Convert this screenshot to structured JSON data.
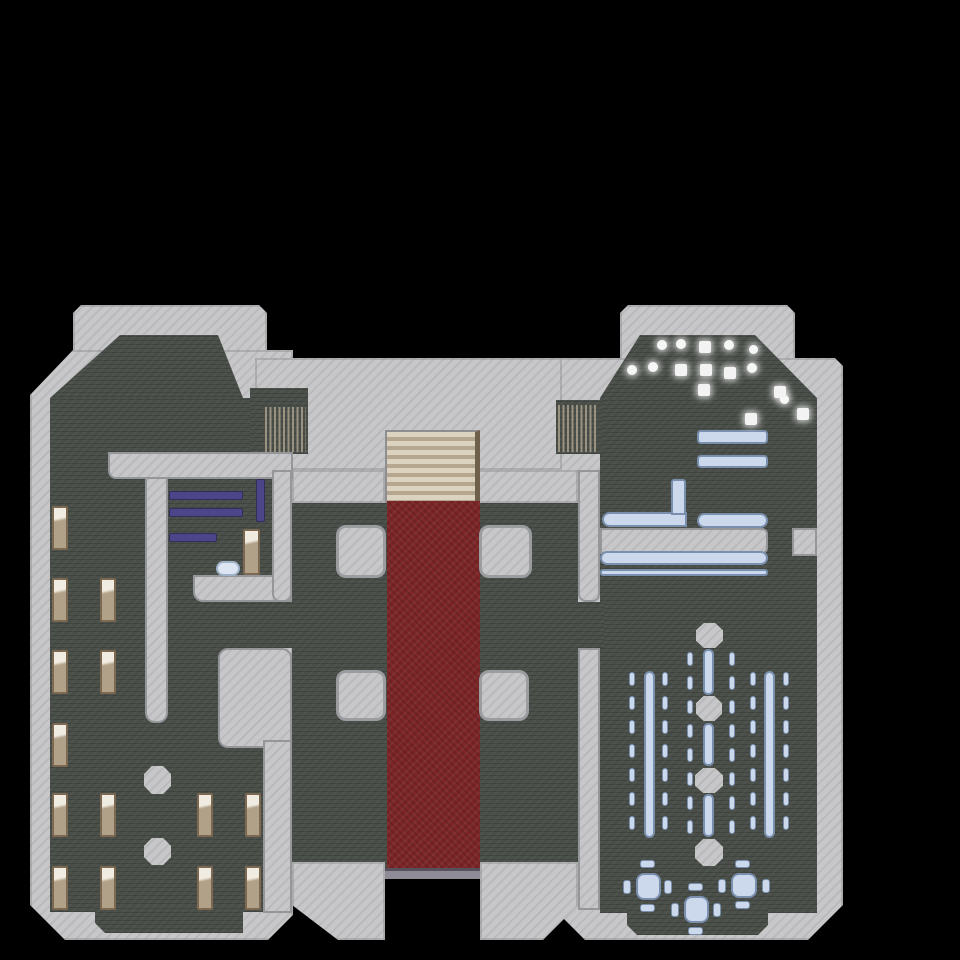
{
  "scene": {
    "name": "castle-floor-map",
    "background": "#000000",
    "width": 960,
    "height": 960
  },
  "palette": {
    "wall": "#c7c7c9",
    "wall_hatch": "#b8b8ba",
    "wall_trim": "#94969a",
    "floor": "#494e48",
    "carpet": "#7d2628",
    "stairs": "#dbd2c0",
    "stairs_stripe": "#b5a78f",
    "wood": "#b2a189",
    "wood_border": "#7d6951",
    "purple": "#4d4589",
    "blue_furniture": "#ccd9ec",
    "blue_border": "#7a8fae",
    "item_white": "#f6f6f6",
    "threshold": "#908c97"
  },
  "elements": [
    {
      "n": "tower-left-wall-cap",
      "c": "wall",
      "x": 73,
      "y": 305,
      "w": 194,
      "h": 90,
      "s": {
        "clipPath": "polygon(8px 0,186px 0,194px 8px,194px 90px,0 90px,0 8px)"
      }
    },
    {
      "n": "wing-left-wall",
      "c": "wall",
      "x": 30,
      "y": 350,
      "w": 263,
      "h": 590,
      "s": {
        "clipPath": "polygon(43px 0,263px 0,263px 565px,238px 590px,35px 590px,0 555px,0 45px)"
      }
    },
    {
      "n": "hall-top-wall-band",
      "c": "wall",
      "x": 255,
      "y": 358,
      "w": 355,
      "h": 112
    },
    {
      "n": "tower-right-wall-cap",
      "c": "wall",
      "x": 620,
      "y": 305,
      "w": 175,
      "h": 60,
      "s": {
        "clipPath": "polygon(8px 0,167px 0,175px 8px,175px 60px,0 60px,0 8px)"
      }
    },
    {
      "n": "wing-right-wall",
      "c": "wall",
      "x": 560,
      "y": 358,
      "w": 283,
      "h": 582,
      "s": {
        "clipPath": "polygon(0 0,275px 0,283px 8px,283px 547px,248px 582px,25px 582px,0 557px)"
      }
    },
    {
      "n": "tower-left-floor",
      "c": "floor",
      "x": 50,
      "y": 335,
      "w": 193,
      "h": 70,
      "s": {
        "clipPath": "polygon(70px 0,168px 0,193px 63px,193px 70px,0 70px,0 63px)"
      }
    },
    {
      "n": "wing-left-floor",
      "c": "floor",
      "x": 50,
      "y": 398,
      "w": 213,
      "h": 514
    },
    {
      "n": "wing-left-floor-south",
      "c": "floor",
      "x": 95,
      "y": 905,
      "w": 148,
      "h": 28,
      "s": {
        "clipPath": "polygon(0 0,148px 0,148px 28px,10px 28px,0 18px)"
      }
    },
    {
      "n": "store-room-floor",
      "c": "floor",
      "x": 243,
      "y": 455,
      "w": 49,
      "h": 193
    },
    {
      "n": "hall-floor",
      "c": "floor",
      "x": 292,
      "y": 470,
      "w": 286,
      "h": 398
    },
    {
      "n": "gate-left-floor",
      "c": "floor",
      "x": 250,
      "y": 388,
      "w": 58,
      "h": 66
    },
    {
      "n": "tower-right-floor",
      "c": "floor",
      "x": 600,
      "y": 335,
      "w": 217,
      "h": 70,
      "s": {
        "clipPath": "polygon(40px 0,155px 0,217px 63px,217px 70px,0 70px,0 63px)"
      }
    },
    {
      "n": "wing-right-floor",
      "c": "floor",
      "x": 600,
      "y": 400,
      "w": 217,
      "h": 513
    },
    {
      "n": "wing-right-floor-south",
      "c": "floor",
      "x": 627,
      "y": 908,
      "w": 141,
      "h": 27,
      "s": {
        "clipPath": "polygon(0 0,141px 0,141px 17px,131px 27px,10px 27px,0 17px)"
      }
    },
    {
      "n": "gate-right-floor",
      "c": "floor",
      "x": 556,
      "y": 400,
      "w": 46,
      "h": 54
    },
    {
      "n": "door-east-floor",
      "c": "floor",
      "x": 578,
      "y": 602,
      "w": 26,
      "h": 46
    },
    {
      "n": "stairs-side-wall-left",
      "c": "wall",
      "x": 292,
      "y": 470,
      "w": 93,
      "h": 33
    },
    {
      "n": "stairs-side-wall-right",
      "c": "wall",
      "x": 478,
      "y": 470,
      "w": 100,
      "h": 33
    },
    {
      "n": "hall-south-wall-left",
      "c": "wall",
      "x": 292,
      "y": 862,
      "w": 93,
      "h": 78,
      "s": {
        "clipPath": "polygon(0 0,93px 0,93px 78px,46px 78px,0 43px)"
      }
    },
    {
      "n": "hall-south-wall-right",
      "c": "wall",
      "x": 480,
      "y": 862,
      "w": 98,
      "h": 78,
      "s": {
        "clipPath": "polygon(0 0,98px 0,98px 43px,63px 78px,0 78px)"
      }
    },
    {
      "n": "dorm-north-wall",
      "c": "iw",
      "x": 108,
      "y": 452,
      "w": 185,
      "h": 27,
      "s": {
        "borderRadius": "0 0 0 8px"
      }
    },
    {
      "n": "dorm-mid-wall",
      "c": "iw",
      "x": 145,
      "y": 477,
      "w": 23,
      "h": 246,
      "s": {
        "borderRadius": "0 0 10px 10px"
      }
    },
    {
      "n": "store-room-south-wall",
      "c": "iw",
      "x": 193,
      "y": 575,
      "w": 99,
      "h": 27,
      "s": {
        "borderRadius": "0 0 0 10px"
      }
    },
    {
      "n": "hall-west-wall-north",
      "c": "iw",
      "x": 272,
      "y": 470,
      "w": 20,
      "h": 132,
      "s": {
        "borderRadius": "0 0 8px 8px"
      }
    },
    {
      "n": "dorm-east-wall-block",
      "c": "iw",
      "x": 218,
      "y": 648,
      "w": 74,
      "h": 100,
      "s": {
        "borderRadius": "10px"
      }
    },
    {
      "n": "dorm-east-wall-strip",
      "c": "iw",
      "x": 263,
      "y": 740,
      "w": 29,
      "h": 173
    },
    {
      "n": "hall-east-wall-north",
      "c": "iw",
      "x": 578,
      "y": 470,
      "w": 22,
      "h": 132,
      "s": {
        "borderRadius": "0 0 8px 8px"
      }
    },
    {
      "n": "hall-east-wall-south",
      "c": "iw",
      "x": 578,
      "y": 648,
      "w": 22,
      "h": 262
    },
    {
      "n": "library-wall-band",
      "c": "iw",
      "x": 600,
      "y": 528,
      "w": 168,
      "h": 26,
      "s": {
        "borderRadius": "0 6px 6px 0"
      }
    },
    {
      "n": "library-wall-stub",
      "c": "iw",
      "x": 792,
      "y": 528,
      "w": 25,
      "h": 28
    },
    {
      "n": "staircase",
      "c": "stairs",
      "x": 385,
      "y": 430,
      "w": 95,
      "h": 73
    },
    {
      "n": "red-carpet",
      "c": "carpet",
      "x": 387,
      "y": 501,
      "w": 93,
      "h": 369
    },
    {
      "n": "south-door-threshold",
      "c": "threshold",
      "x": 385,
      "y": 868,
      "w": 95,
      "h": 11
    },
    {
      "n": "hall-pillar-nw",
      "c": "pillar",
      "x": 336,
      "y": 525,
      "w": 50,
      "h": 53
    },
    {
      "n": "hall-pillar-ne",
      "c": "pillar",
      "x": 479,
      "y": 525,
      "w": 53,
      "h": 53
    },
    {
      "n": "hall-pillar-sw",
      "c": "pillar",
      "x": 336,
      "y": 670,
      "w": 50,
      "h": 51
    },
    {
      "n": "hall-pillar-se",
      "c": "pillar",
      "x": 479,
      "y": 670,
      "w": 50,
      "h": 51
    },
    {
      "n": "dorm-column",
      "c": "oct",
      "x": 144,
      "y": 766,
      "w": 27,
      "h": 28
    },
    {
      "n": "dorm-column",
      "c": "oct",
      "x": 144,
      "y": 838,
      "w": 27,
      "h": 27
    },
    {
      "n": "dining-column",
      "c": "oct",
      "x": 696,
      "y": 623,
      "w": 27,
      "h": 25
    },
    {
      "n": "dining-column",
      "c": "oct",
      "x": 696,
      "y": 696,
      "w": 26,
      "h": 25
    },
    {
      "n": "dining-column",
      "c": "oct",
      "x": 695,
      "y": 768,
      "w": 28,
      "h": 25
    },
    {
      "n": "dining-column",
      "c": "oct",
      "x": 695,
      "y": 839,
      "w": 28,
      "h": 27
    },
    {
      "n": "portcullis-left",
      "c": "gate",
      "x": 265,
      "y": 407,
      "w": 41,
      "h": 45
    },
    {
      "n": "portcullis-right",
      "c": "gate",
      "x": 558,
      "y": 405,
      "w": 40,
      "h": 47
    },
    {
      "n": "bed",
      "c": "bed",
      "x": 52,
      "y": 506,
      "w": 16,
      "h": 44
    },
    {
      "n": "bed",
      "c": "bed",
      "x": 52,
      "y": 578,
      "w": 16,
      "h": 44
    },
    {
      "n": "bed",
      "c": "bed",
      "x": 100,
      "y": 578,
      "w": 16,
      "h": 44
    },
    {
      "n": "bed",
      "c": "bed",
      "x": 52,
      "y": 650,
      "w": 16,
      "h": 44
    },
    {
      "n": "bed",
      "c": "bed",
      "x": 100,
      "y": 650,
      "w": 16,
      "h": 44
    },
    {
      "n": "bed",
      "c": "bed",
      "x": 52,
      "y": 723,
      "w": 16,
      "h": 44
    },
    {
      "n": "bed",
      "c": "bed",
      "x": 52,
      "y": 793,
      "w": 16,
      "h": 44
    },
    {
      "n": "bed",
      "c": "bed",
      "x": 100,
      "y": 793,
      "w": 16,
      "h": 44
    },
    {
      "n": "bed",
      "c": "bed",
      "x": 197,
      "y": 793,
      "w": 16,
      "h": 44
    },
    {
      "n": "bed",
      "c": "bed",
      "x": 245,
      "y": 793,
      "w": 16,
      "h": 44
    },
    {
      "n": "bed",
      "c": "bed",
      "x": 52,
      "y": 866,
      "w": 16,
      "h": 44
    },
    {
      "n": "bed",
      "c": "bed",
      "x": 100,
      "y": 866,
      "w": 16,
      "h": 44
    },
    {
      "n": "bed",
      "c": "bed",
      "x": 197,
      "y": 866,
      "w": 16,
      "h": 44
    },
    {
      "n": "bed",
      "c": "bed",
      "x": 245,
      "y": 866,
      "w": 16,
      "h": 44
    },
    {
      "n": "cabinet",
      "c": "bed",
      "x": 243,
      "y": 529,
      "w": 17,
      "h": 46
    },
    {
      "n": "pillow",
      "c": "pillow",
      "x": 216,
      "y": 561,
      "w": 24,
      "h": 15
    },
    {
      "n": "shelf",
      "c": "shelf",
      "x": 169,
      "y": 491,
      "w": 74,
      "h": 9
    },
    {
      "n": "shelf",
      "c": "shelf",
      "x": 169,
      "y": 508,
      "w": 74,
      "h": 9
    },
    {
      "n": "shelf",
      "c": "shelf",
      "x": 169,
      "y": 533,
      "w": 48,
      "h": 9
    },
    {
      "n": "shelf-vertical",
      "c": "shelf",
      "x": 256,
      "y": 479,
      "w": 9,
      "h": 43
    },
    {
      "n": "table",
      "c": "btable",
      "x": 697,
      "y": 430,
      "w": 71,
      "h": 14,
      "s": {
        "borderRadius": "4px"
      }
    },
    {
      "n": "table",
      "c": "btable",
      "x": 697,
      "y": 455,
      "w": 71,
      "h": 13,
      "s": {
        "borderRadius": "4px"
      }
    },
    {
      "n": "table-l-horizontal",
      "c": "btable",
      "x": 602,
      "y": 512,
      "w": 85,
      "h": 15,
      "s": {
        "borderRadius": "8px 0 0 8px"
      }
    },
    {
      "n": "table-l-vertical",
      "c": "btable",
      "x": 671,
      "y": 479,
      "w": 15,
      "h": 36,
      "s": {
        "borderRadius": "3px 3px 0 0"
      }
    },
    {
      "n": "table",
      "c": "btable",
      "x": 697,
      "y": 513,
      "w": 71,
      "h": 15,
      "s": {
        "borderRadius": "8px"
      }
    },
    {
      "n": "long-table",
      "c": "btable",
      "x": 600,
      "y": 551,
      "w": 168,
      "h": 14,
      "s": {
        "borderRadius": "8px"
      }
    },
    {
      "n": "long-bench",
      "c": "btable",
      "x": 600,
      "y": 569,
      "w": 168,
      "h": 7,
      "s": {
        "borderRadius": "3px"
      }
    },
    {
      "n": "dining-table-left",
      "c": "btable",
      "x": 644,
      "y": 671,
      "w": 11,
      "h": 167,
      "s": {
        "borderRadius": "6px"
      }
    },
    {
      "n": "dining-table-right",
      "c": "btable",
      "x": 764,
      "y": 671,
      "w": 11,
      "h": 167,
      "s": {
        "borderRadius": "6px"
      }
    },
    {
      "n": "dining-table-center",
      "c": "btable",
      "x": 703,
      "y": 649,
      "w": 11,
      "h": 46,
      "s": {
        "borderRadius": "5px"
      }
    },
    {
      "n": "dining-table-center",
      "c": "btable",
      "x": 703,
      "y": 723,
      "w": 11,
      "h": 43,
      "s": {
        "borderRadius": "5px"
      }
    },
    {
      "n": "dining-table-center",
      "c": "btable",
      "x": 703,
      "y": 794,
      "w": 11,
      "h": 43,
      "s": {
        "borderRadius": "5px"
      }
    },
    {
      "n": "dining-chair",
      "c": "chair",
      "x": 629,
      "w": 6,
      "h": 14,
      "ry": [
        672,
        696,
        720,
        744,
        768,
        792,
        816
      ]
    },
    {
      "n": "dining-chair",
      "c": "chair",
      "x": 662,
      "w": 6,
      "h": 14,
      "ry": [
        672,
        696,
        720,
        744,
        768,
        792,
        816
      ]
    },
    {
      "n": "dining-chair",
      "c": "chair",
      "x": 750,
      "w": 6,
      "h": 14,
      "ry": [
        672,
        696,
        720,
        744,
        768,
        792,
        816
      ]
    },
    {
      "n": "dining-chair",
      "c": "chair",
      "x": 783,
      "w": 6,
      "h": 14,
      "ry": [
        672,
        696,
        720,
        744,
        768,
        792,
        816
      ]
    },
    {
      "n": "dining-chair",
      "c": "chair",
      "x": 687,
      "w": 6,
      "h": 14,
      "ry": [
        652,
        676,
        700,
        724,
        748,
        772,
        796,
        820
      ]
    },
    {
      "n": "dining-chair",
      "c": "chair",
      "x": 729,
      "w": 6,
      "h": 14,
      "ry": [
        652,
        676,
        700,
        724,
        748,
        772,
        796,
        820
      ]
    },
    {
      "n": "round-table",
      "c": "btable",
      "x": 636,
      "y": 873,
      "w": 25,
      "h": 27,
      "s": {
        "borderRadius": "8px"
      }
    },
    {
      "n": "round-table",
      "c": "btable",
      "x": 731,
      "y": 873,
      "w": 26,
      "h": 25,
      "s": {
        "borderRadius": "8px"
      }
    },
    {
      "n": "round-table",
      "c": "btable",
      "x": 684,
      "y": 896,
      "w": 25,
      "h": 27,
      "s": {
        "borderRadius": "8px"
      }
    },
    {
      "n": "table-chair",
      "c": "chair",
      "x": 640,
      "y": 860,
      "w": 15,
      "h": 8
    },
    {
      "n": "table-chair",
      "c": "chair",
      "x": 640,
      "y": 904,
      "w": 15,
      "h": 8
    },
    {
      "n": "table-chair",
      "c": "chair",
      "x": 623,
      "y": 880,
      "w": 8,
      "h": 14
    },
    {
      "n": "table-chair",
      "c": "chair",
      "x": 664,
      "y": 880,
      "w": 8,
      "h": 14
    },
    {
      "n": "table-chair",
      "c": "chair",
      "x": 735,
      "y": 860,
      "w": 15,
      "h": 8
    },
    {
      "n": "table-chair",
      "c": "chair",
      "x": 735,
      "y": 901,
      "w": 15,
      "h": 8
    },
    {
      "n": "table-chair",
      "c": "chair",
      "x": 718,
      "y": 879,
      "w": 8,
      "h": 14
    },
    {
      "n": "table-chair",
      "c": "chair",
      "x": 762,
      "y": 879,
      "w": 8,
      "h": 14
    },
    {
      "n": "table-chair",
      "c": "chair",
      "x": 688,
      "y": 883,
      "w": 15,
      "h": 8
    },
    {
      "n": "table-chair",
      "c": "chair",
      "x": 688,
      "y": 927,
      "w": 15,
      "h": 8
    },
    {
      "n": "table-chair",
      "c": "chair",
      "x": 671,
      "y": 903,
      "w": 8,
      "h": 14
    },
    {
      "n": "table-chair",
      "c": "chair",
      "x": 713,
      "y": 903,
      "w": 8,
      "h": 14
    },
    {
      "n": "loot-item",
      "c": "item-c",
      "x": 657,
      "y": 340,
      "w": 10,
      "h": 10
    },
    {
      "n": "loot-item",
      "c": "item-c",
      "x": 676,
      "y": 339,
      "w": 10,
      "h": 10
    },
    {
      "n": "loot-item",
      "c": "item-c",
      "x": 724,
      "y": 340,
      "w": 10,
      "h": 10
    },
    {
      "n": "loot-item",
      "c": "item-c",
      "x": 749,
      "y": 345,
      "w": 9,
      "h": 9
    },
    {
      "n": "loot-item",
      "c": "item-c",
      "x": 627,
      "y": 365,
      "w": 10,
      "h": 10
    },
    {
      "n": "loot-item",
      "c": "item-c",
      "x": 648,
      "y": 362,
      "w": 10,
      "h": 10
    },
    {
      "n": "loot-item",
      "c": "item-c",
      "x": 747,
      "y": 363,
      "w": 10,
      "h": 10
    },
    {
      "n": "loot-item",
      "c": "item-c",
      "x": 780,
      "y": 395,
      "w": 9,
      "h": 9
    },
    {
      "n": "loot-item",
      "c": "item-s",
      "x": 699,
      "y": 341,
      "w": 12,
      "h": 12
    },
    {
      "n": "loot-item",
      "c": "item-s",
      "x": 675,
      "y": 364,
      "w": 12,
      "h": 12
    },
    {
      "n": "loot-item",
      "c": "item-s",
      "x": 700,
      "y": 364,
      "w": 12,
      "h": 12
    },
    {
      "n": "loot-item",
      "c": "item-s",
      "x": 724,
      "y": 367,
      "w": 12,
      "h": 12
    },
    {
      "n": "loot-item",
      "c": "item-s",
      "x": 698,
      "y": 384,
      "w": 12,
      "h": 12
    },
    {
      "n": "loot-item",
      "c": "item-s",
      "x": 774,
      "y": 386,
      "w": 12,
      "h": 12
    },
    {
      "n": "loot-item",
      "c": "item-s",
      "x": 797,
      "y": 408,
      "w": 12,
      "h": 12
    },
    {
      "n": "loot-item",
      "c": "item-s",
      "x": 745,
      "y": 413,
      "w": 12,
      "h": 12
    }
  ]
}
